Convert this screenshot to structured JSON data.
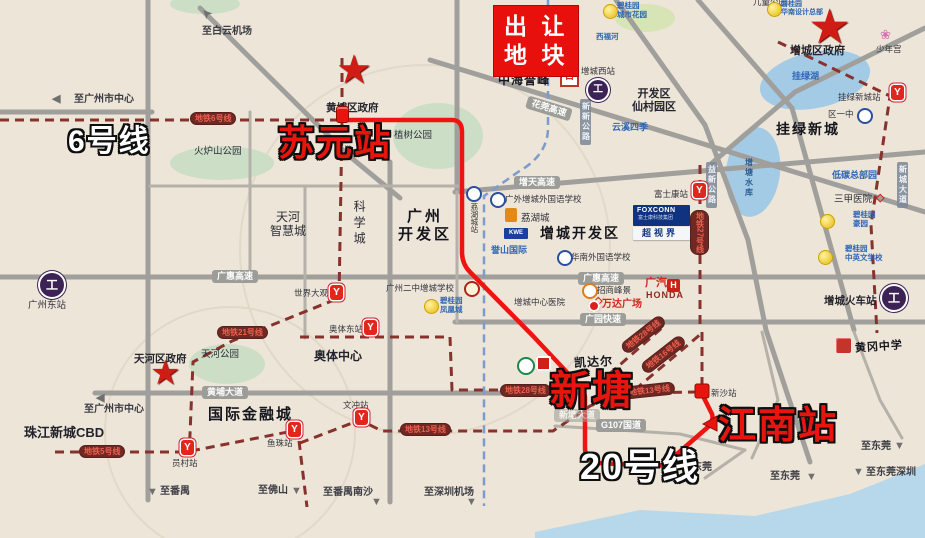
{
  "map": {
    "title_plot": "出 让\n地 块",
    "colors": {
      "background": "#ece5d8",
      "route_red": "#ef1410",
      "metro_line": "#87322c",
      "intercity_blue": "#7b9ccd",
      "road_gray": "#a09f9c",
      "lake_blue": "#a4cbe5",
      "plot_box_red": "#e8100c"
    },
    "items": [
      {
        "n": "arrow-baiyun-airport",
        "t": "➤",
        "x": 201,
        "y": 6,
        "c": "arr",
        "r": -135
      },
      {
        "n": "dest-baiyun-airport",
        "t": "至白云机场",
        "x": 202,
        "y": 26,
        "c": "dest"
      },
      {
        "n": "arrow-gz-center-top",
        "t": "◀",
        "x": 52,
        "y": 93,
        "c": "arr2"
      },
      {
        "n": "dest-gz-center-top",
        "t": "至广州市中心",
        "x": 74,
        "y": 94,
        "c": "dest"
      },
      {
        "n": "metro-line6-label",
        "t": "地铁6号线",
        "x": 190,
        "y": 112,
        "c": "mlbl"
      },
      {
        "n": "label-line6-big",
        "t": "6号线",
        "x": 68,
        "y": 124,
        "c": "bigw"
      },
      {
        "n": "star-huangpu-gov-icon",
        "t": "★",
        "x": 336,
        "y": 50,
        "c": "star",
        "fs": 40
      },
      {
        "n": "label-huangpu-gov",
        "t": "黄埔区政府",
        "x": 326,
        "y": 102,
        "c": "pl2"
      },
      {
        "n": "pin-suyuan-icon",
        "t": "",
        "x": 336,
        "y": 106,
        "c": "pin"
      },
      {
        "n": "label-suyuan-big",
        "t": "苏元站",
        "x": 278,
        "y": 122,
        "c": "bigr"
      },
      {
        "n": "label-zhishu-park",
        "t": "植树公园",
        "x": 394,
        "y": 130,
        "c": "pl"
      },
      {
        "n": "label-huolushan-park",
        "t": "火炉山公园",
        "x": 194,
        "y": 146,
        "c": "pl"
      },
      {
        "n": "plot-box",
        "t": "出 让\n地 块",
        "x": 494,
        "y": 6,
        "c": "plot"
      },
      {
        "n": "label-zhonghai",
        "t": "中海誉峰",
        "x": 498,
        "y": 73,
        "c": "cal2",
        "fs": 12
      },
      {
        "n": "logo-zhonghai-icon",
        "t": "日",
        "x": 560,
        "y": 66,
        "c": "zh-logo"
      },
      {
        "n": "label-zc-west-station",
        "t": "增城西站",
        "x": 581,
        "y": 66,
        "c": "sm"
      },
      {
        "n": "icon-zc-west-rail",
        "t": "工",
        "x": 588,
        "y": 80,
        "c": "ricon"
      },
      {
        "n": "logo-bgy-city-garden-icon",
        "t": "",
        "x": 603,
        "y": 4,
        "c": "bgy"
      },
      {
        "n": "label-bgy-city-garden",
        "t": "碧桂园\n城市花园",
        "x": 617,
        "y": 2,
        "c": "bl"
      },
      {
        "n": "label-xifu-river",
        "t": "西福河",
        "x": 596,
        "y": 33,
        "c": "bl"
      },
      {
        "n": "label-yunxi-siji",
        "t": "云溪四季",
        "x": 612,
        "y": 122,
        "c": "bl2"
      },
      {
        "n": "label-kaifaqu-xiancun",
        "t": "开发区\n仙村园区",
        "x": 632,
        "y": 88,
        "c": "pl3c"
      },
      {
        "n": "label-ertong-park",
        "t": "儿童公园",
        "x": 753,
        "y": -3,
        "c": "sm"
      },
      {
        "n": "star-zc-gov-icon",
        "t": "★",
        "x": 808,
        "y": 4,
        "c": "star",
        "fs": 48
      },
      {
        "n": "label-zc-gov",
        "t": "增城区政府",
        "x": 790,
        "y": 45,
        "c": "pl3"
      },
      {
        "n": "logo-bgy-hq-icon",
        "t": "",
        "x": 767,
        "y": 2,
        "c": "bgy"
      },
      {
        "n": "label-bgy-hq",
        "t": "碧桂园\n华南设计总部",
        "x": 781,
        "y": 1,
        "c": "bl",
        "fs": 7
      },
      {
        "n": "icon-shaoniangong-flower",
        "t": "❀",
        "x": 880,
        "y": 27,
        "c": "flower"
      },
      {
        "n": "label-shaoniangong",
        "t": "少年宫",
        "x": 876,
        "y": 44,
        "c": "sm"
      },
      {
        "n": "label-gualv-lake",
        "t": "挂绿湖",
        "x": 792,
        "y": 71,
        "c": "bl2"
      },
      {
        "n": "label-gualv-newtown-station",
        "t": "挂绿新城站",
        "x": 838,
        "y": 92,
        "c": "sm"
      },
      {
        "n": "icon-gualv-newtown-metro",
        "t": "Y",
        "x": 891,
        "y": 85,
        "c": "micon"
      },
      {
        "n": "label-quyizhong",
        "t": "区一中",
        "x": 828,
        "y": 109,
        "c": "sm"
      },
      {
        "n": "icon-quyizhong-badge",
        "t": "",
        "x": 857,
        "y": 108,
        "c": "badge-b"
      },
      {
        "n": "label-gualv-newtown",
        "t": "挂绿新城",
        "x": 776,
        "y": 122,
        "c": "cal"
      },
      {
        "n": "label-xincheng-avenue",
        "t": "新城大道",
        "x": 897,
        "y": 162,
        "c": "vroad"
      },
      {
        "n": "label-xinxin-road",
        "t": "新新公路",
        "x": 580,
        "y": 99,
        "c": "vroad"
      },
      {
        "n": "label-huamo-hwy",
        "t": "花莞高速",
        "x": 526,
        "y": 102,
        "c": "rlbl",
        "r": 17
      },
      {
        "n": "label-tianhe-smart-city",
        "t": "天河\n智慧城",
        "x": 270,
        "y": 210,
        "c": "plc"
      },
      {
        "n": "label-kexuecheng",
        "t": "科学城",
        "x": 352,
        "y": 200,
        "c": "vpl"
      },
      {
        "n": "label-gz-kaifaqu",
        "t": "广州\n开发区",
        "x": 398,
        "y": 208,
        "c": "calc"
      },
      {
        "n": "icon-lihucheng-station-badge",
        "t": "",
        "x": 466,
        "y": 186,
        "c": "badge-b"
      },
      {
        "n": "label-lihucheng-station",
        "t": "荔湖城站",
        "x": 469,
        "y": 203,
        "c": "vsm"
      },
      {
        "n": "label-zengtian-hwy",
        "t": "增天高速",
        "x": 514,
        "y": 176,
        "c": "rlbl"
      },
      {
        "n": "icon-gwzc-school-badge",
        "t": "",
        "x": 490,
        "y": 192,
        "c": "badge-b"
      },
      {
        "n": "label-gwzc-school",
        "t": "广外增城外国语学校",
        "x": 505,
        "y": 194,
        "c": "sm"
      },
      {
        "n": "logo-orange-icon",
        "t": "",
        "x": 505,
        "y": 208,
        "c": "obox"
      },
      {
        "n": "label-lihucheng",
        "t": "荔湖城",
        "x": 521,
        "y": 213,
        "c": "pl"
      },
      {
        "n": "logo-kwe-icon",
        "t": "KWE",
        "x": 504,
        "y": 228,
        "c": "kwe"
      },
      {
        "n": "label-yushan-intl",
        "t": "誉山国际",
        "x": 491,
        "y": 245,
        "c": "bl2"
      },
      {
        "n": "label-zc-kaifaqu",
        "t": "增城开发区",
        "x": 540,
        "y": 226,
        "c": "cal"
      },
      {
        "n": "icon-huanan-school-badge",
        "t": "",
        "x": 557,
        "y": 250,
        "c": "badge-b"
      },
      {
        "n": "label-huanan-school",
        "t": "华南外国语学校",
        "x": 571,
        "y": 252,
        "c": "sm"
      },
      {
        "n": "label-foxconn-station",
        "t": "富士康站",
        "x": 654,
        "y": 189,
        "c": "sm"
      },
      {
        "n": "icon-foxconn-metro",
        "t": "Y",
        "x": 693,
        "y": 183,
        "c": "micon"
      },
      {
        "n": "metro-line27-label",
        "t": "地铁27号线",
        "x": 690,
        "y": 210,
        "c": "mlbl vmlbl"
      },
      {
        "n": "label-yixin-road",
        "t": "益新公路",
        "x": 706,
        "y": 162,
        "c": "vroad"
      },
      {
        "n": "label-zengtang-reservoir",
        "t": "增塘水库",
        "x": 744,
        "y": 158,
        "c": "vblue"
      },
      {
        "n": "logo-foxconn-bg",
        "t": "",
        "x": 633,
        "y": 205,
        "c": "foxbg"
      },
      {
        "n": "label-foxconn-brand",
        "t": "FOXCONN",
        "x": 637,
        "y": 207,
        "c": "foxt"
      },
      {
        "n": "label-foxconn-group",
        "t": "富士康科技集团",
        "x": 638,
        "y": 216,
        "c": "foxt2"
      },
      {
        "n": "logo-chaoshijie-strip",
        "t": "",
        "x": 633,
        "y": 227,
        "c": "foxstrip"
      },
      {
        "n": "label-chaoshijie",
        "t": "超视界",
        "x": 642,
        "y": 228,
        "c": "foxt3"
      },
      {
        "n": "label-ditan-hq",
        "t": "低碳总部园",
        "x": 832,
        "y": 170,
        "c": "bl2"
      },
      {
        "n": "label-sanjia-hospital",
        "t": "三甲医院",
        "x": 834,
        "y": 194,
        "c": "pl"
      },
      {
        "n": "icon-sanjia-diamond",
        "t": "◇",
        "x": 876,
        "y": 192,
        "c": "dia"
      },
      {
        "n": "logo-bgy-haoyuan-icon",
        "t": "",
        "x": 820,
        "y": 214,
        "c": "bgy"
      },
      {
        "n": "label-bgy-haoyuan",
        "t": "碧桂园\n豪园",
        "x": 853,
        "y": 211,
        "c": "bl"
      },
      {
        "n": "logo-bgy-school-icon",
        "t": "",
        "x": 818,
        "y": 250,
        "c": "bgy"
      },
      {
        "n": "label-bgy-school",
        "t": "碧桂园\n中英文学校",
        "x": 845,
        "y": 245,
        "c": "bl"
      },
      {
        "n": "label-zc-railway-station",
        "t": "增城火车站",
        "x": 824,
        "y": 295,
        "c": "pl2"
      },
      {
        "n": "icon-zc-railway",
        "t": "工",
        "x": 882,
        "y": 286,
        "c": "ricon2"
      },
      {
        "n": "label-guanghui-hwy-west",
        "t": "广惠高速",
        "x": 212,
        "y": 270,
        "c": "rlbl"
      },
      {
        "n": "label-guanghui-hwy-east",
        "t": "广惠高速",
        "x": 578,
        "y": 272,
        "c": "rlbl"
      },
      {
        "n": "label-world-scenery",
        "t": "世界大观",
        "x": 294,
        "y": 288,
        "c": "sm"
      },
      {
        "n": "icon-world-scenery-metro",
        "t": "Y",
        "x": 330,
        "y": 285,
        "c": "micon"
      },
      {
        "n": "label-gz2z-school",
        "t": "广州二中增城学校",
        "x": 386,
        "y": 283,
        "c": "sm"
      },
      {
        "n": "icon-gz2z-school-badge",
        "t": "",
        "x": 464,
        "y": 281,
        "c": "badge-r"
      },
      {
        "n": "logo-bgy-fhc-icon",
        "t": "",
        "x": 424,
        "y": 299,
        "c": "bgy"
      },
      {
        "n": "label-bgy-fenghuangcheng",
        "t": "碧桂园\n凤凰城",
        "x": 440,
        "y": 297,
        "c": "bl"
      },
      {
        "n": "label-zc-hospital",
        "t": "增城中心医院",
        "x": 514,
        "y": 297,
        "c": "sm"
      },
      {
        "n": "icon-zc-hospital-diamond",
        "t": "◇",
        "x": 594,
        "y": 295,
        "c": "dia"
      },
      {
        "n": "logo-zhaoshang-icon",
        "t": "",
        "x": 582,
        "y": 283,
        "c": "ocirc"
      },
      {
        "n": "label-zhaoshang",
        "t": "招商峰景",
        "x": 597,
        "y": 285,
        "c": "sm"
      },
      {
        "n": "label-gq",
        "t": "广汽",
        "x": 645,
        "y": 277,
        "c": "redb",
        "fs": 11
      },
      {
        "n": "logo-honda-h-icon",
        "t": "H",
        "x": 667,
        "y": 279,
        "c": "hbox"
      },
      {
        "n": "label-honda",
        "t": "HONDA",
        "x": 646,
        "y": 290,
        "c": "honda"
      },
      {
        "n": "logo-wanda-icon",
        "t": "",
        "x": 588,
        "y": 300,
        "c": "ocirc2"
      },
      {
        "n": "label-wanda",
        "t": "万达广场",
        "x": 602,
        "y": 299,
        "c": "redb",
        "fs": 10
      },
      {
        "n": "label-guangyuan-exp",
        "t": "广园快速",
        "x": 580,
        "y": 313,
        "c": "rlbl"
      },
      {
        "n": "metro-line21-label",
        "t": "地铁21号线",
        "x": 217,
        "y": 326,
        "c": "mlbl"
      },
      {
        "n": "logo-huanggang-icon",
        "t": "",
        "x": 836,
        "y": 338,
        "c": "redcube"
      },
      {
        "n": "label-huanggang-school",
        "t": "黄冈中学",
        "x": 855,
        "y": 341,
        "c": "cal2",
        "fs": 11,
        "r": -4
      },
      {
        "n": "label-tianhe-gov",
        "t": "天河区政府",
        "x": 134,
        "y": 353,
        "c": "pl2"
      },
      {
        "n": "star-tianhe-gov-icon",
        "t": "★",
        "x": 150,
        "y": 356,
        "c": "star",
        "fs": 34
      },
      {
        "n": "label-tianhe-park",
        "t": "天河公园",
        "x": 201,
        "y": 349,
        "c": "pl"
      },
      {
        "n": "label-huangpu-avenue",
        "t": "黄埔大道",
        "x": 202,
        "y": 386,
        "c": "rlbl"
      },
      {
        "n": "arrow-gz-center-bottom",
        "t": "◀",
        "x": 96,
        "y": 392,
        "c": "arr2"
      },
      {
        "n": "dest-gz-center-bottom",
        "t": "至广州市中心",
        "x": 84,
        "y": 404,
        "c": "dest"
      },
      {
        "n": "label-zjnc-cbd",
        "t": "珠江新城CBD",
        "x": 24,
        "y": 425,
        "c": "pl3",
        "fs": 13
      },
      {
        "n": "label-intl-finance-city",
        "t": "国际金融城",
        "x": 208,
        "y": 406,
        "c": "cal",
        "fs": 15
      },
      {
        "n": "metro-line5-label",
        "t": "地铁5号线",
        "x": 79,
        "y": 445,
        "c": "mlbl"
      },
      {
        "n": "icon-yuancun-metro",
        "t": "Y",
        "x": 181,
        "y": 440,
        "c": "micon"
      },
      {
        "n": "label-yuancun-station",
        "t": "员村站",
        "x": 172,
        "y": 458,
        "c": "sm"
      },
      {
        "n": "icon-yuzhu-metro",
        "t": "Y",
        "x": 288,
        "y": 422,
        "c": "micon"
      },
      {
        "n": "label-yuzhu-station",
        "t": "鱼珠站",
        "x": 267,
        "y": 438,
        "c": "sm"
      },
      {
        "n": "label-aoti-center",
        "t": "奥体中心",
        "x": 314,
        "y": 349,
        "c": "pl3",
        "fs": 12
      },
      {
        "n": "label-aoti-east-station",
        "t": "奥体东站",
        "x": 329,
        "y": 324,
        "c": "sm"
      },
      {
        "n": "icon-aoti-east-metro",
        "t": "Y",
        "x": 364,
        "y": 320,
        "c": "micon"
      },
      {
        "n": "label-wenchong-station",
        "t": "文冲站",
        "x": 343,
        "y": 400,
        "c": "sm"
      },
      {
        "n": "icon-wenchong-metro",
        "t": "Y",
        "x": 355,
        "y": 410,
        "c": "micon"
      },
      {
        "n": "metro-line13-label-west",
        "t": "地铁13号线",
        "x": 400,
        "y": 423,
        "c": "mlbl"
      },
      {
        "n": "metro-line28-label-west",
        "t": "地铁28号线",
        "x": 500,
        "y": 384,
        "c": "mlbl"
      },
      {
        "n": "arrow-panyu",
        "t": "▼",
        "x": 147,
        "y": 486,
        "c": "arr2"
      },
      {
        "n": "dest-panyu",
        "t": "至番禺",
        "x": 160,
        "y": 486,
        "c": "dest"
      },
      {
        "n": "dest-foshan",
        "t": "至佛山",
        "x": 258,
        "y": 485,
        "c": "dest"
      },
      {
        "n": "arrow-foshan",
        "t": "▼",
        "x": 291,
        "y": 485,
        "c": "arr2"
      },
      {
        "n": "dest-panyu-nansha",
        "t": "至番禺南沙",
        "x": 323,
        "y": 487,
        "c": "dest"
      },
      {
        "n": "arrow-panyu-nansha",
        "t": "▼",
        "x": 371,
        "y": 496,
        "c": "arr2"
      },
      {
        "n": "dest-sz-airport",
        "t": "至深圳机场",
        "x": 424,
        "y": 487,
        "c": "dest"
      },
      {
        "n": "arrow-sz-airport",
        "t": "▼",
        "x": 466,
        "y": 496,
        "c": "arr2"
      },
      {
        "n": "label-kaidaer",
        "t": "凯达尔",
        "x": 574,
        "y": 355,
        "c": "cal2",
        "fs": 12,
        "r": -3
      },
      {
        "n": "logo-green-icon",
        "t": "",
        "x": 517,
        "y": 357,
        "c": "gcirc"
      },
      {
        "n": "logo-red-square-icon",
        "t": "",
        "x": 536,
        "y": 356,
        "c": "rsq"
      },
      {
        "n": "label-xintang-avenue",
        "t": "新塘大道",
        "x": 554,
        "y": 409,
        "c": "rlbl fade"
      },
      {
        "n": "label-xintang-big",
        "t": "新塘",
        "x": 550,
        "y": 368,
        "c": "bigr",
        "fs": 40
      },
      {
        "n": "metro-line13-label-east",
        "t": "地铁13号线",
        "x": 624,
        "y": 384,
        "c": "mlbl",
        "r": -6
      },
      {
        "n": "label-xinsha-station",
        "t": "新沙站",
        "x": 711,
        "y": 388,
        "c": "sm"
      },
      {
        "n": "metro-line28-label-east",
        "t": "地铁28号线",
        "x": 618,
        "y": 328,
        "c": "mlbl",
        "r": -38
      },
      {
        "n": "metro-line16-label",
        "t": "地铁16号线",
        "x": 638,
        "y": 348,
        "c": "mlbl",
        "r": -38
      },
      {
        "n": "label-jiangnan-big",
        "t": "江南站",
        "x": 718,
        "y": 404,
        "c": "bigr",
        "fs": 38
      },
      {
        "n": "label-g107",
        "t": "G107国道",
        "x": 596,
        "y": 419,
        "c": "rlbl"
      },
      {
        "n": "label-line20-big",
        "t": "20号线",
        "x": 580,
        "y": 446,
        "c": "bigw",
        "fs": 36
      },
      {
        "n": "dest-dongguan-1",
        "t": "至东莞",
        "x": 682,
        "y": 462,
        "c": "dest"
      },
      {
        "n": "arrow-dongguan-1",
        "t": "▼",
        "x": 688,
        "y": 476,
        "c": "arr2"
      },
      {
        "n": "dest-dongguan-2",
        "t": "至东莞",
        "x": 770,
        "y": 471,
        "c": "dest"
      },
      {
        "n": "arrow-dongguan-2",
        "t": "▼",
        "x": 806,
        "y": 471,
        "c": "arr2"
      },
      {
        "n": "dest-dongguan-3",
        "t": "至东莞",
        "x": 861,
        "y": 441,
        "c": "dest"
      },
      {
        "n": "arrow-dongguan-3",
        "t": "▼",
        "x": 894,
        "y": 440,
        "c": "arr2"
      },
      {
        "n": "arrow-dongguan-shenzhen",
        "t": "▼",
        "x": 853,
        "y": 466,
        "c": "arr2"
      },
      {
        "n": "dest-dongguan-shenzhen",
        "t": "至东莞深圳",
        "x": 866,
        "y": 467,
        "c": "dest"
      },
      {
        "n": "label-gz-east-station",
        "t": "广州东站",
        "x": 28,
        "y": 300,
        "c": "pl"
      },
      {
        "n": "icon-gz-east-rail",
        "t": "工",
        "x": 40,
        "y": 273,
        "c": "ricon2"
      }
    ]
  }
}
